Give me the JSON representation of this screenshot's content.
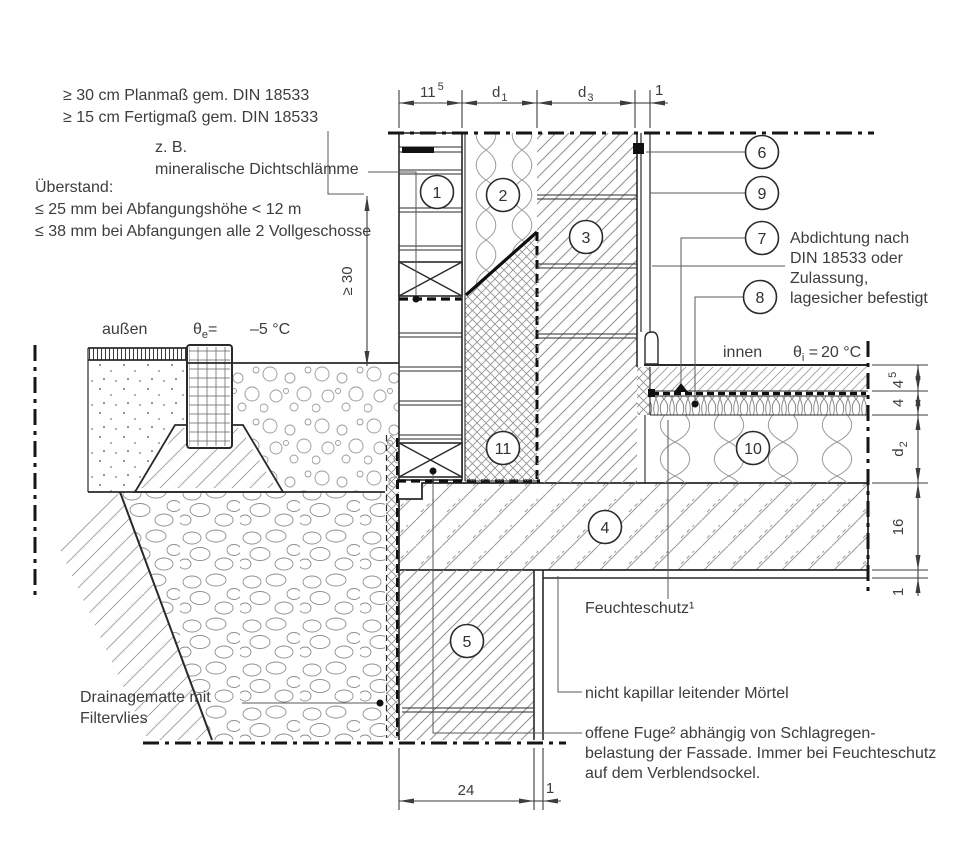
{
  "title": "Sockelanschluss Detail (construction section detail)",
  "notes": {
    "planmass": {
      "line1": "≥ 30 cm Planmaß gem. DIN 18533",
      "line2": "≥ 15 cm Fertigmaß gem. DIN 18533"
    },
    "dichtschlaemme": {
      "line1": "z. B.",
      "line2": "mineralische Dichtschlämme"
    },
    "ueberstand": {
      "line1": "Überstand:",
      "line2": "≤ 25 mm bei Abfangungshöhe < 12 m",
      "line3": "≤ 38 mm bei Abfangungen alle 2 Vollgeschosse"
    },
    "abdichtung": {
      "line1": "Abdichtung nach",
      "line2": "DIN 18533 oder",
      "line3": "Zulassung,",
      "line4": "lagesicher befestigt"
    },
    "feuchteschutz": "Feuchteschutz¹",
    "moertel": "nicht kapillar leitender Mörtel",
    "offene_fuge": {
      "line1": "offene Fuge² abhängig von Schlagregen-",
      "line2": "belastung der Fassade. Immer bei Feuchteschutz",
      "line3": "auf dem Verblendsockel."
    },
    "drainage": {
      "line1": "Drainagematte mit",
      "line2": "Filtervlies"
    }
  },
  "temps": {
    "outside_label": "außen",
    "outside_symbol": "θ",
    "outside_sub": "e",
    "outside_eq": "=",
    "outside_value": "–5 °C",
    "inside_label": "innen",
    "inside_symbol": "θ",
    "inside_sub": "i",
    "inside_eq": " =",
    "inside_value": "20 °C"
  },
  "callouts": {
    "c1": "1",
    "c2": "2",
    "c3": "3",
    "c4": "4",
    "c5": "5",
    "c6": "6",
    "c7": "7",
    "c8": "8",
    "c9": "9",
    "c10": "10",
    "c11": "11"
  },
  "dims": {
    "top": {
      "d1_main": "11",
      "d1_sup": "5",
      "d2_main": "d",
      "d2_sub": "1",
      "d3_main": "d",
      "d3_sub": "3",
      "d4": "1"
    },
    "right": {
      "r1_main": "4",
      "r1_sup": "5",
      "r2": "4",
      "r3_main": "d",
      "r3_sub": "2",
      "r4": "16",
      "r5": "1"
    },
    "bottom": {
      "b1": "24",
      "b2": "1"
    },
    "height": "≥ 30"
  },
  "colors": {
    "line": "#2a2a2a",
    "text": "#3d3d3d",
    "hatch": "#8f8f8f",
    "seal_black": "#0f0f0f",
    "background": "#ffffff"
  }
}
